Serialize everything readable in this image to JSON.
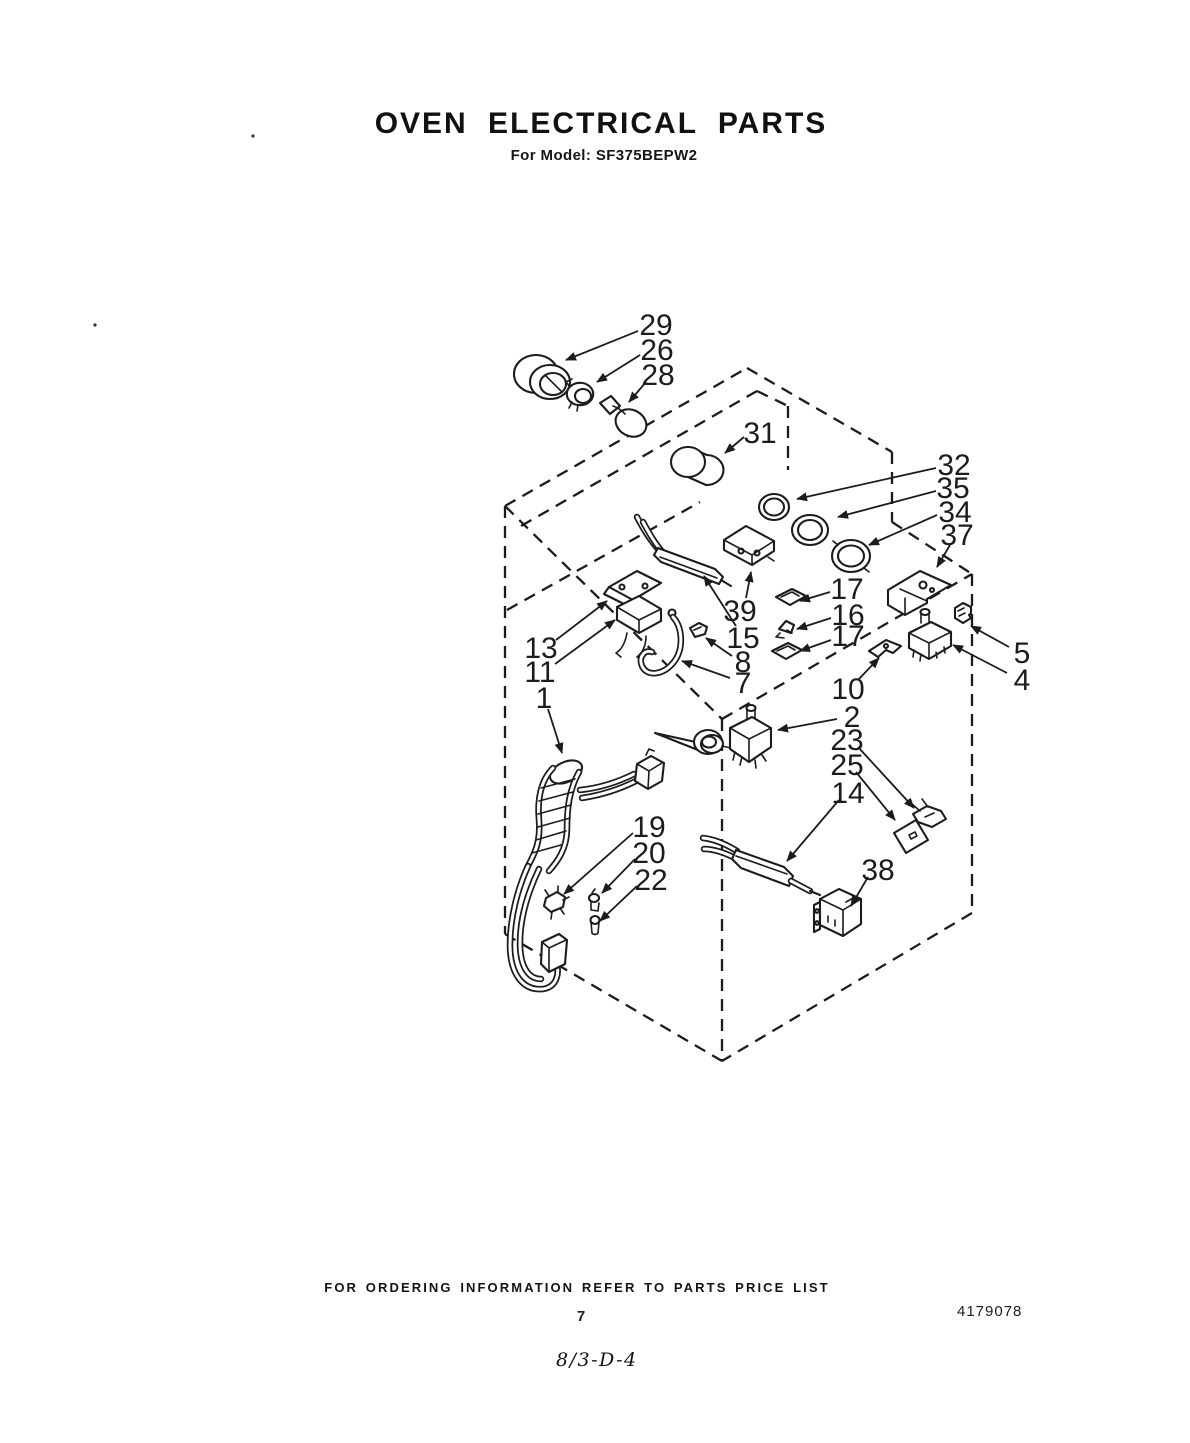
{
  "document": {
    "title": "OVEN ELECTRICAL PARTS",
    "model_line": "For Model: SF375BEPW2",
    "footer_note": "FOR ORDERING INFORMATION REFER TO PARTS PRICE LIST",
    "page_number": "7",
    "document_number": "4179078",
    "handwritten_note": "8/3-D-4"
  },
  "colors": {
    "ink": "#1c1c1c",
    "paper": "#ffffff"
  },
  "diagram": {
    "kind": "exploded-parts-diagram",
    "subject": "oven cabinet with electrical components, isometric dashed outline",
    "part_numbers_shown": [
      "29",
      "26",
      "28",
      "31",
      "32",
      "35",
      "34",
      "37",
      "39",
      "15",
      "13",
      "11",
      "7",
      "8",
      "17",
      "16",
      "17",
      "5",
      "4",
      "10",
      "2",
      "23",
      "25",
      "14",
      "38",
      "1",
      "19",
      "20",
      "22"
    ],
    "callouts": [
      {
        "t": "29",
        "lx": 656,
        "ly": 324,
        "sx": 638,
        "sy": 331,
        "tx": 566,
        "ty": 360
      },
      {
        "t": "26",
        "lx": 657,
        "ly": 349,
        "sx": 640,
        "sy": 355,
        "tx": 597,
        "ty": 382
      },
      {
        "t": "28",
        "lx": 658,
        "ly": 374,
        "sx": 646,
        "sy": 382,
        "tx": 629,
        "ty": 402
      },
      {
        "t": "31",
        "lx": 760,
        "ly": 432,
        "sx": 744,
        "sy": 437,
        "tx": 725,
        "ty": 453
      },
      {
        "t": "32",
        "lx": 954,
        "ly": 464,
        "sx": 936,
        "sy": 468,
        "tx": 797,
        "ty": 499
      },
      {
        "t": "35",
        "lx": 953,
        "ly": 487,
        "sx": 936,
        "sy": 491,
        "tx": 838,
        "ty": 517
      },
      {
        "t": "34",
        "lx": 955,
        "ly": 511,
        "sx": 937,
        "sy": 515,
        "tx": 869,
        "ty": 545
      },
      {
        "t": "37",
        "lx": 957,
        "ly": 534,
        "sx": 950,
        "sy": 545,
        "tx": 937,
        "ty": 567
      },
      {
        "t": "39",
        "lx": 740,
        "ly": 610,
        "sx": 746,
        "sy": 598,
        "tx": 751,
        "ty": 572
      },
      {
        "t": "15",
        "lx": 743,
        "ly": 637,
        "sx": 736,
        "sy": 626,
        "tx": 704,
        "ty": 576
      },
      {
        "t": "8",
        "lx": 743,
        "ly": 661,
        "sx": 732,
        "sy": 656,
        "tx": 706,
        "ty": 638
      },
      {
        "t": "7",
        "lx": 743,
        "ly": 682,
        "sx": 730,
        "sy": 678,
        "tx": 682,
        "ty": 661
      },
      {
        "t": "13",
        "lx": 541,
        "ly": 647,
        "sx": 556,
        "sy": 640,
        "tx": 607,
        "ty": 601
      },
      {
        "t": "11",
        "lx": 540,
        "ly": 671,
        "sx": 555,
        "sy": 664,
        "tx": 615,
        "ty": 620
      },
      {
        "t": "1",
        "lx": 544,
        "ly": 697,
        "sx": 548,
        "sy": 709,
        "tx": 562,
        "ty": 753
      },
      {
        "t": "17",
        "lx": 847,
        "ly": 588,
        "sx": 830,
        "sy": 592,
        "tx": 800,
        "ty": 601
      },
      {
        "t": "16",
        "lx": 848,
        "ly": 614,
        "sx": 831,
        "sy": 618,
        "tx": 797,
        "ty": 629
      },
      {
        "t": "17",
        "lx": 848,
        "ly": 635,
        "sx": 831,
        "sy": 640,
        "tx": 800,
        "ty": 651
      },
      {
        "t": "5",
        "lx": 1022,
        "ly": 652,
        "sx": 1009,
        "sy": 647,
        "tx": 971,
        "ty": 626
      },
      {
        "t": "4",
        "lx": 1022,
        "ly": 679,
        "sx": 1007,
        "sy": 673,
        "tx": 953,
        "ty": 645
      },
      {
        "t": "10",
        "lx": 848,
        "ly": 688,
        "sx": 858,
        "sy": 680,
        "tx": 879,
        "ty": 658
      },
      {
        "t": "2",
        "lx": 852,
        "ly": 716,
        "sx": 837,
        "sy": 719,
        "tx": 778,
        "ty": 730
      },
      {
        "t": "23",
        "lx": 847,
        "ly": 739,
        "sx": 858,
        "sy": 747,
        "tx": 914,
        "ty": 808
      },
      {
        "t": "25",
        "lx": 847,
        "ly": 764,
        "sx": 856,
        "sy": 772,
        "tx": 895,
        "ty": 820
      },
      {
        "t": "14",
        "lx": 848,
        "ly": 792,
        "sx": 839,
        "sy": 800,
        "tx": 787,
        "ty": 861
      },
      {
        "t": "38",
        "lx": 878,
        "ly": 869,
        "sx": 868,
        "sy": 877,
        "tx": 851,
        "ty": 906
      },
      {
        "t": "19",
        "lx": 649,
        "ly": 826,
        "sx": 633,
        "sy": 833,
        "tx": 564,
        "ty": 894
      },
      {
        "t": "20",
        "lx": 649,
        "ly": 852,
        "sx": 635,
        "sy": 859,
        "tx": 602,
        "ty": 893
      },
      {
        "t": "22",
        "lx": 651,
        "ly": 879,
        "sx": 637,
        "sy": 886,
        "tx": 600,
        "ty": 921
      }
    ]
  }
}
